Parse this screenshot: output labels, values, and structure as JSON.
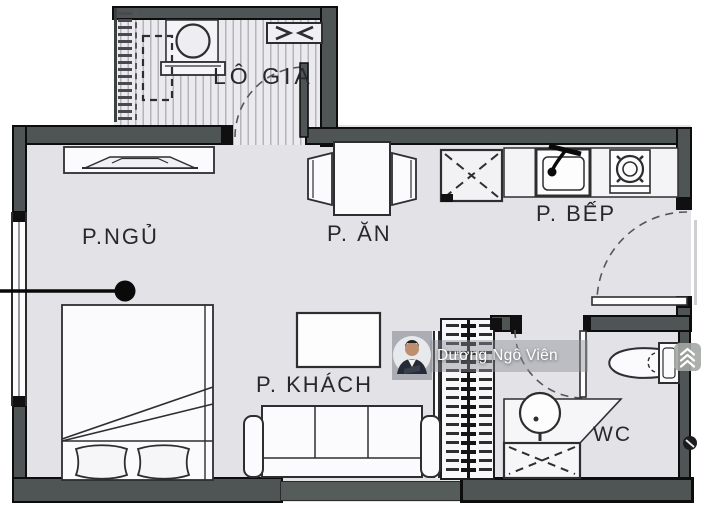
{
  "plan": {
    "rooms": {
      "loggia": {
        "label": "LÔ GIA"
      },
      "bedroom": {
        "label": "P.NGỦ"
      },
      "dining": {
        "label": "P. ĂN"
      },
      "kitchen": {
        "label": "P. BẾP"
      },
      "living": {
        "label": "P. KHÁCH"
      },
      "wc": {
        "label": "WC"
      }
    },
    "furniture": [
      "washing-machine",
      "drying-unit",
      "console-cabinet",
      "double-bed",
      "pillows",
      "dining-table",
      "dining-chairs",
      "refrigerator-space",
      "kitchen-sink",
      "cooktop",
      "sofa",
      "coffee-table",
      "toilet",
      "wash-basin",
      "shower",
      "technical-shaft"
    ],
    "colors": {
      "wall": "#4f5555",
      "floor": "#e3e3e7",
      "loggia_floor": "#ebebef",
      "outline": "#2e2e30"
    }
  },
  "watermark": {
    "name": "Dương Ngô Viên",
    "badge_icon": "double-chevron-up"
  }
}
